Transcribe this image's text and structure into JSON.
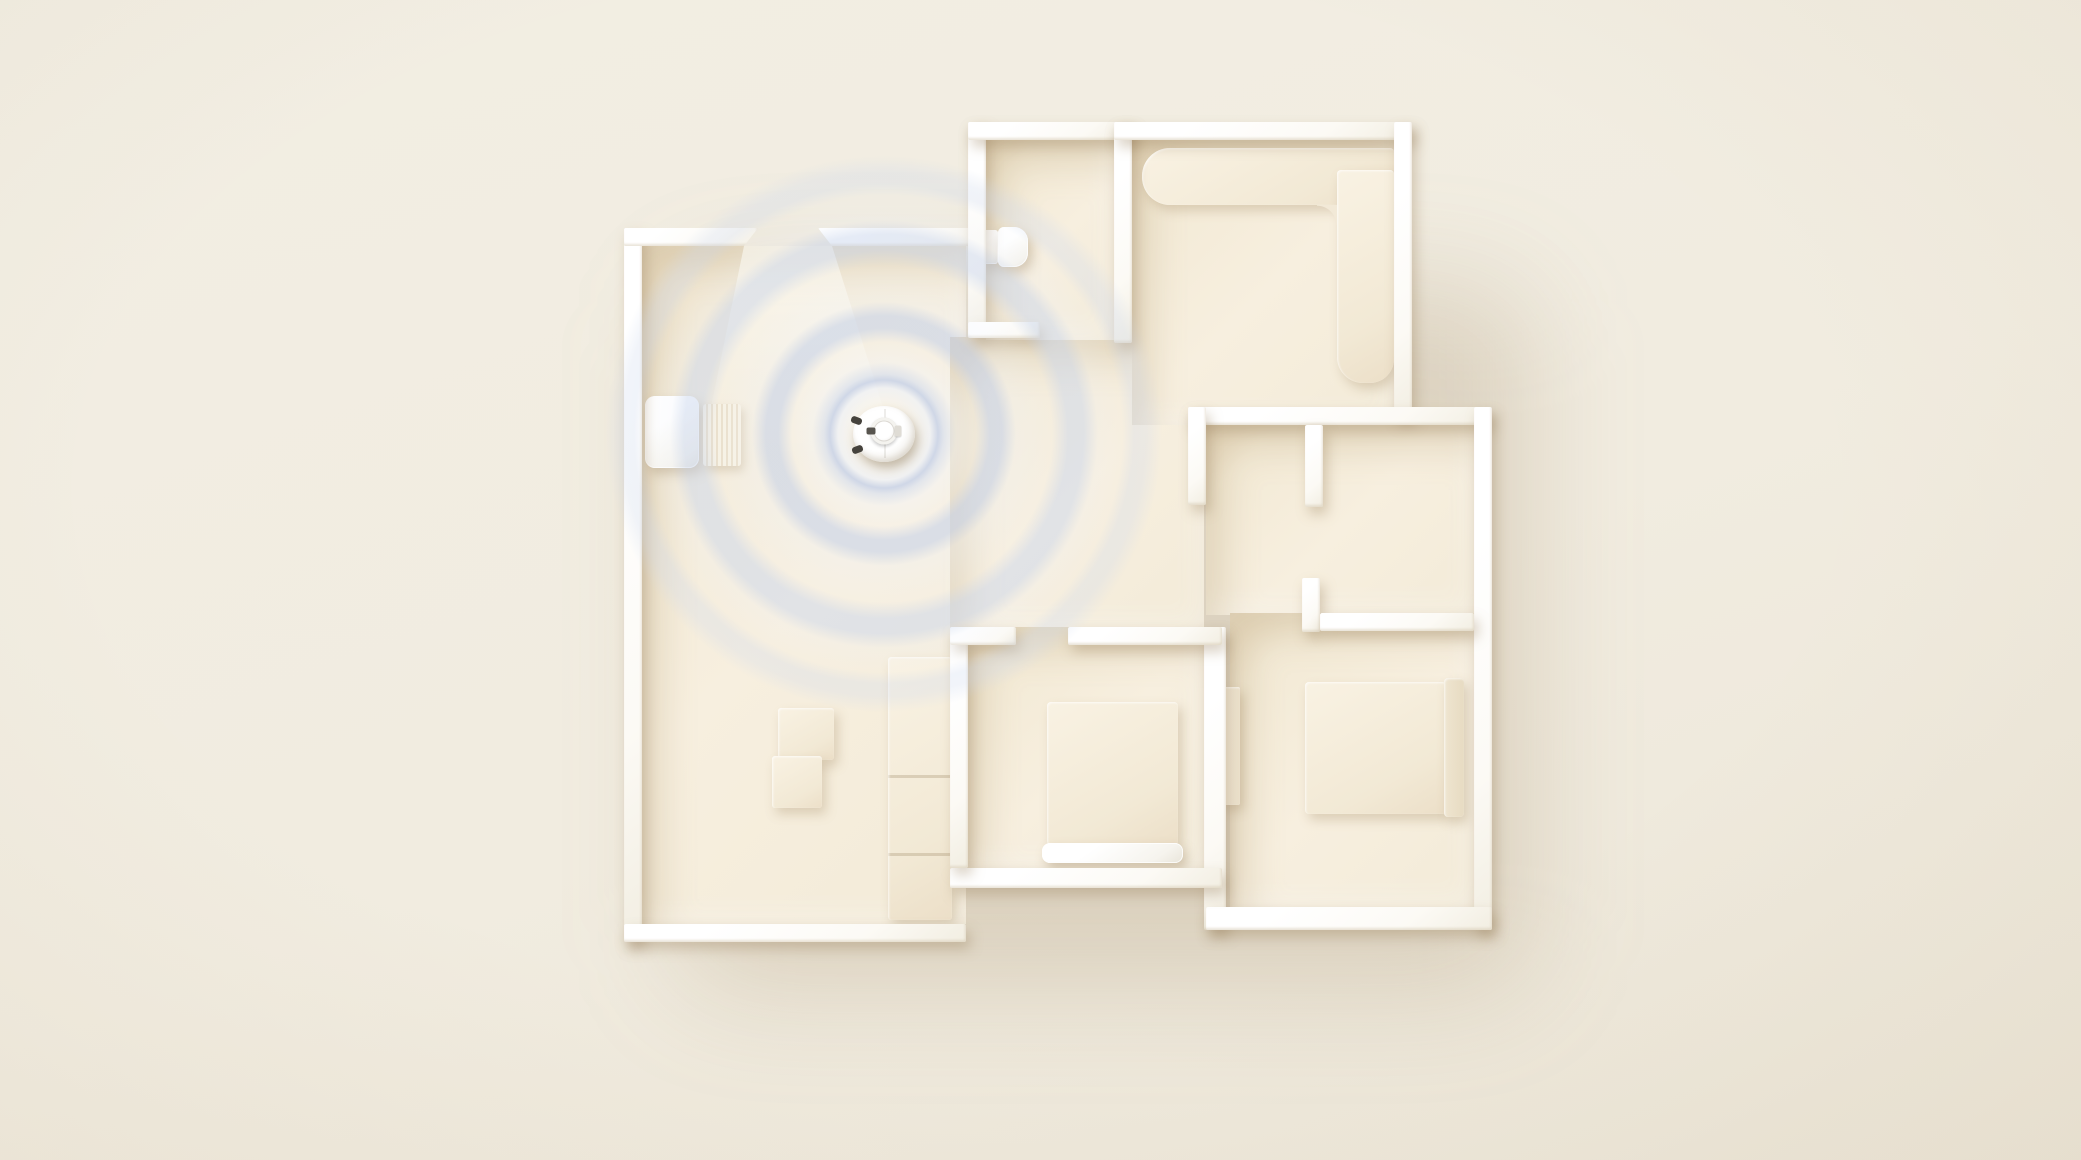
{
  "scene": {
    "width": 2081,
    "height": 1160,
    "description": "Top-down 3D render of an apartment floor plan with a robot vacuum emitting LiDAR mapping rings next to its charging dock",
    "background_color": "#f1ece0"
  },
  "palette": {
    "wall": "#fdfcf8",
    "floor": "#f4ecda",
    "furniture": "#f3ead8",
    "device_white": "#ffffff",
    "ring_blue": "#c7d2e9",
    "shadow": "rgba(150,124,86,0.35)"
  },
  "shadow_blob": {
    "name": "plan-ground-shadow",
    "x": 660,
    "y": 260,
    "w": 850,
    "h": 700
  },
  "layers": {
    "floors": [
      {
        "name": "floor-living-room",
        "x": 642,
        "y": 246,
        "w": 324,
        "h": 678
      },
      {
        "name": "floor-hallway",
        "x": 950,
        "y": 337,
        "w": 254,
        "h": 292
      },
      {
        "name": "floor-bathroom",
        "x": 986,
        "y": 140,
        "w": 128,
        "h": 200
      },
      {
        "name": "floor-kitchen",
        "x": 1132,
        "y": 140,
        "w": 262,
        "h": 285
      },
      {
        "name": "floor-study-nook",
        "x": 1206,
        "y": 425,
        "w": 268,
        "h": 190
      },
      {
        "name": "floor-bedroom-small",
        "x": 966,
        "y": 627,
        "w": 238,
        "h": 241
      },
      {
        "name": "floor-bedroom-corner",
        "x": 1230,
        "y": 613,
        "w": 244,
        "h": 294
      }
    ],
    "lights": [
      {
        "name": "door-light-beam",
        "x": 700,
        "y": 246,
        "w": 200,
        "h": 215
      }
    ],
    "furniture": [
      {
        "name": "charging-dock-base",
        "x": 645,
        "y": 396,
        "w": 54,
        "h": 72,
        "r": "10px",
        "extra": "white"
      },
      {
        "name": "charging-dock-ramp",
        "x": 703,
        "y": 404,
        "w": 38,
        "h": 62,
        "r": "3px",
        "extra": "ribbed"
      },
      {
        "name": "toilet-tank",
        "x": 978,
        "y": 230,
        "w": 20,
        "h": 34,
        "r": "3px",
        "extra": "white"
      },
      {
        "name": "toilet-bowl",
        "x": 998,
        "y": 227,
        "w": 30,
        "h": 40,
        "r": "6px 14px 14px 6px",
        "extra": "white"
      },
      {
        "name": "kitchen-counter-long",
        "x": 1142,
        "y": 148,
        "w": 252,
        "h": 57,
        "r": "28px 4px 4px 28px"
      },
      {
        "name": "kitchen-counter-side",
        "x": 1337,
        "y": 170,
        "w": 57,
        "h": 213,
        "r": "4px 4px 24px 26px"
      },
      {
        "name": "kitchen-counter-fillet",
        "x": 1317,
        "y": 205,
        "w": 20,
        "h": 20,
        "extra": "fillet"
      },
      {
        "name": "living-cabinet",
        "x": 888,
        "y": 657,
        "w": 64,
        "h": 263,
        "r": "3px",
        "extra": "cabinet"
      },
      {
        "name": "coffee-table-large",
        "x": 778,
        "y": 708,
        "w": 56,
        "h": 52,
        "r": "3px"
      },
      {
        "name": "coffee-table-small",
        "x": 772,
        "y": 756,
        "w": 50,
        "h": 52,
        "r": "3px"
      },
      {
        "name": "bed-small",
        "x": 1047,
        "y": 702,
        "w": 131,
        "h": 143,
        "r": "4px"
      },
      {
        "name": "bed-small-footboard",
        "x": 1042,
        "y": 843,
        "w": 141,
        "h": 20,
        "r": "8px",
        "extra": "white"
      },
      {
        "name": "bed-corner",
        "x": 1305,
        "y": 682,
        "w": 141,
        "h": 132,
        "r": "4px"
      },
      {
        "name": "bed-corner-headboard",
        "x": 1444,
        "y": 678,
        "w": 20,
        "h": 139,
        "r": "4px",
        "fill": "linear-gradient(90deg,#efe5d0,#e7dbc2)"
      },
      {
        "name": "bedroom-corner-closet",
        "x": 1220,
        "y": 687,
        "w": 20,
        "h": 118,
        "r": "2px",
        "fill": "linear-gradient(90deg,#f6efe0,#ece1cb)"
      }
    ],
    "walls": [
      {
        "name": "wall-living-left",
        "x": 624,
        "y": 228,
        "w": 18,
        "h": 714
      },
      {
        "name": "wall-living-bottom",
        "x": 624,
        "y": 924,
        "w": 342,
        "h": 18
      },
      {
        "name": "wall-living-top-left",
        "x": 624,
        "y": 228,
        "w": 134,
        "h": 18,
        "extra": "chamfer-right"
      },
      {
        "name": "wall-living-top-right",
        "x": 818,
        "y": 228,
        "w": 168,
        "h": 18,
        "extra": "chamfer-left"
      },
      {
        "name": "wall-bathroom-left",
        "x": 968,
        "y": 122,
        "w": 18,
        "h": 215
      },
      {
        "name": "wall-bathroom-top",
        "x": 968,
        "y": 122,
        "w": 164,
        "h": 18
      },
      {
        "name": "wall-bathroom-kitchen-divider",
        "x": 1114,
        "y": 122,
        "w": 18,
        "h": 221
      },
      {
        "name": "wall-bathroom-bottom",
        "x": 968,
        "y": 322,
        "w": 72,
        "h": 16
      },
      {
        "name": "wall-kitchen-top",
        "x": 1114,
        "y": 122,
        "w": 298,
        "h": 18
      },
      {
        "name": "wall-kitchen-right",
        "x": 1394,
        "y": 122,
        "w": 18,
        "h": 296
      },
      {
        "name": "wall-mid-top",
        "x": 1188,
        "y": 407,
        "w": 302,
        "h": 18
      },
      {
        "name": "wall-outer-right",
        "x": 1474,
        "y": 407,
        "w": 18,
        "h": 523
      },
      {
        "name": "wall-closet-stub-left",
        "x": 1188,
        "y": 407,
        "w": 18,
        "h": 98
      },
      {
        "name": "wall-closet-stub-right",
        "x": 1305,
        "y": 425,
        "w": 18,
        "h": 82
      },
      {
        "name": "wall-nook-stub",
        "x": 1302,
        "y": 578,
        "w": 18,
        "h": 54
      },
      {
        "name": "wall-nook",
        "x": 1320,
        "y": 613,
        "w": 154,
        "h": 18
      },
      {
        "name": "wall-bedrooms-divider",
        "x": 1204,
        "y": 627,
        "w": 22,
        "h": 303
      },
      {
        "name": "wall-bedroom-corner-bottom",
        "x": 1206,
        "y": 907,
        "w": 286,
        "h": 23
      },
      {
        "name": "wall-bedroom-small-bottom",
        "x": 950,
        "y": 868,
        "w": 272,
        "h": 20
      },
      {
        "name": "wall-bedroom-small-left",
        "x": 950,
        "y": 627,
        "w": 18,
        "h": 241
      },
      {
        "name": "wall-bedroom-small-top-left",
        "x": 950,
        "y": 627,
        "w": 66,
        "h": 18
      },
      {
        "name": "wall-bedroom-small-top-right",
        "x": 1068,
        "y": 627,
        "w": 154,
        "h": 18
      }
    ]
  },
  "robot": {
    "name": "robot-vacuum",
    "cx": 884,
    "cy": 434,
    "body_w": 62,
    "body_h": 56,
    "turret_d": 27
  },
  "radar": {
    "name": "lidar-radar-rings",
    "cx": 884,
    "cy": 434,
    "radius": 280,
    "ring_radii": [
      55,
      112,
      192,
      257
    ],
    "stops": [
      {
        "color": "rgba(255,255,255,0)",
        "at": 0
      },
      {
        "color": "rgba(252,253,255,0.38)",
        "at": 30
      },
      {
        "color": "rgba(238,243,252,0.66)",
        "at": 46
      },
      {
        "color": "rgba(196,208,233,0.78)",
        "at": 54
      },
      {
        "color": "rgba(214,224,243,0.62)",
        "at": 60
      },
      {
        "color": "rgba(244,247,253,0.42)",
        "at": 72
      },
      {
        "color": "rgba(246,248,253,0.22)",
        "at": 92
      },
      {
        "color": "rgba(199,211,235,0.60)",
        "at": 106
      },
      {
        "color": "rgba(199,211,235,0.60)",
        "at": 118
      },
      {
        "color": "rgba(240,244,251,0.30)",
        "at": 132
      },
      {
        "color": "rgba(244,246,252,0.12)",
        "at": 168
      },
      {
        "color": "rgba(203,215,237,0.50)",
        "at": 184
      },
      {
        "color": "rgba(203,215,237,0.50)",
        "at": 200
      },
      {
        "color": "rgba(238,242,250,0.20)",
        "at": 214
      },
      {
        "color": "rgba(240,243,250,0.06)",
        "at": 238
      },
      {
        "color": "rgba(206,217,238,0.30)",
        "at": 250
      },
      {
        "color": "rgba(206,217,238,0.28)",
        "at": 262
      },
      {
        "color": "rgba(255,255,255,0)",
        "at": 278
      }
    ]
  }
}
